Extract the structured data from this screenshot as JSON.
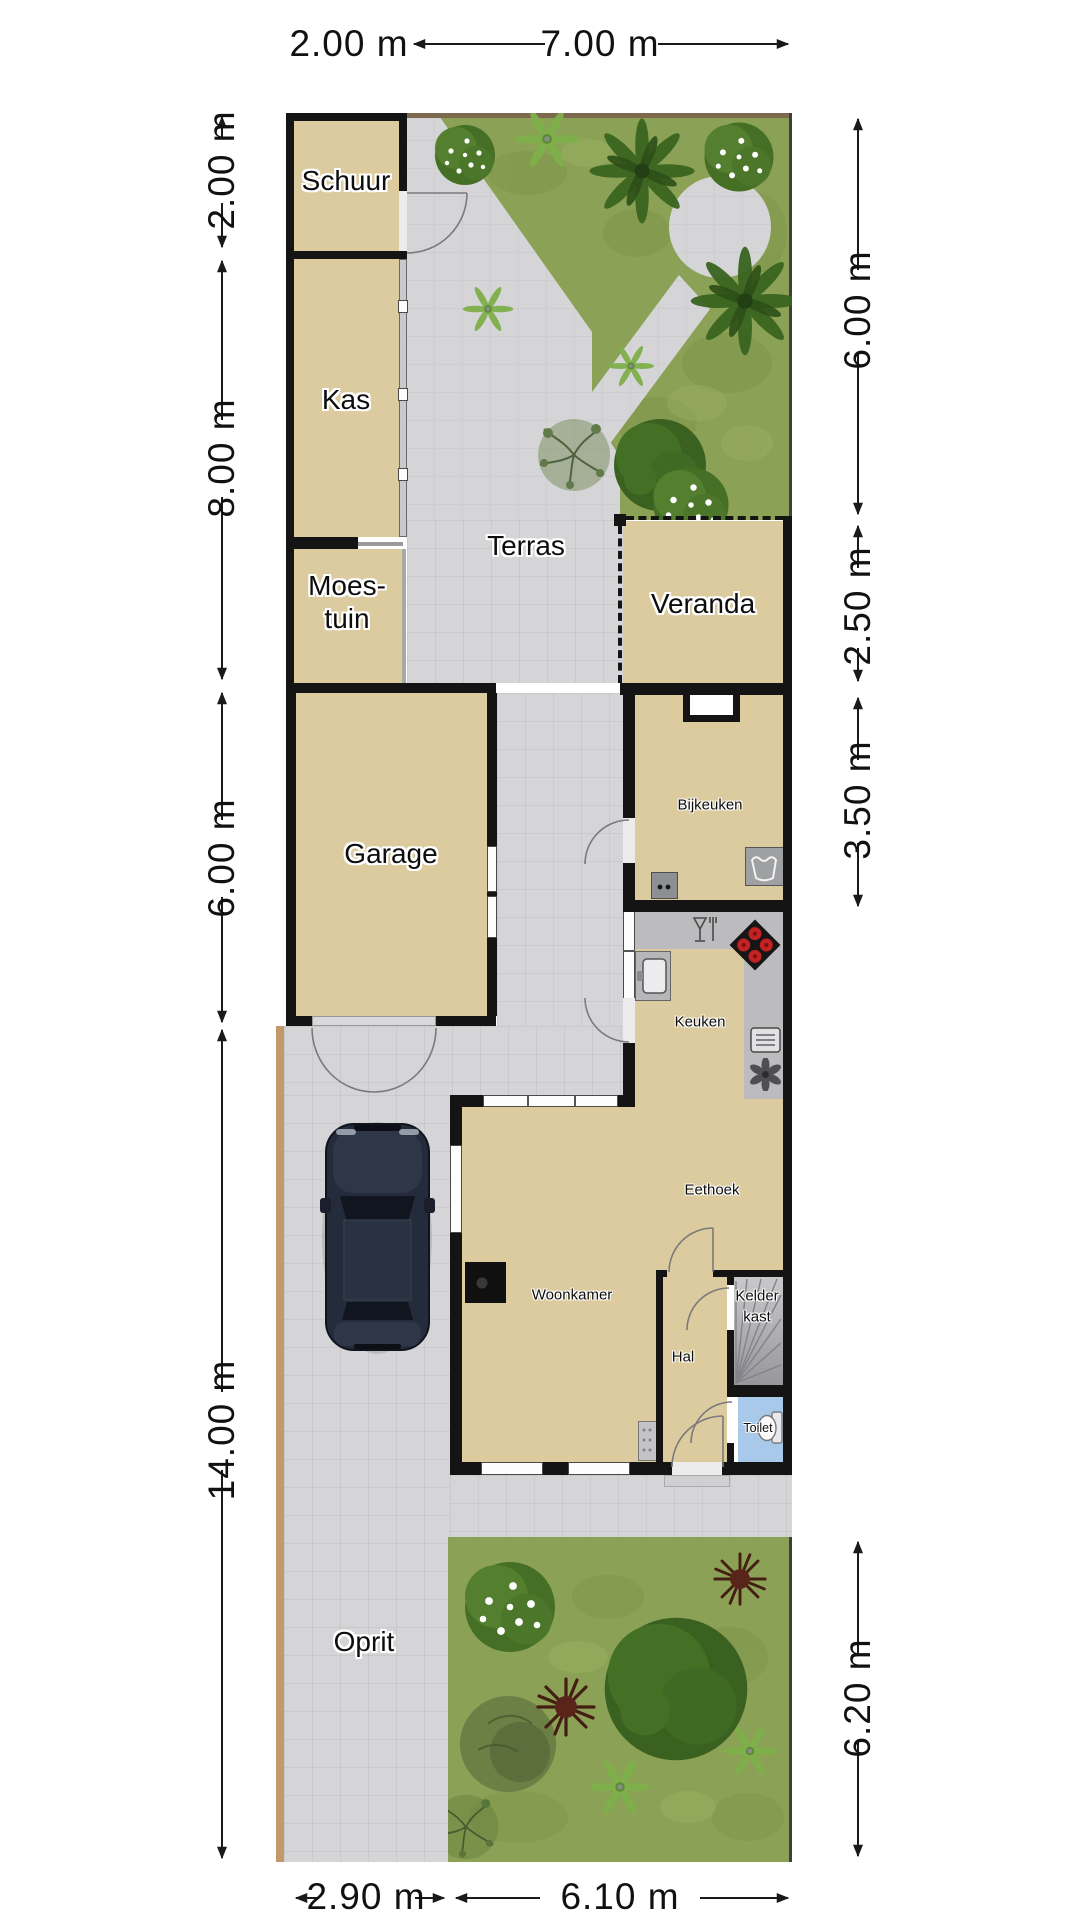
{
  "plan": {
    "type": "floorplan-with-garden",
    "rooms": {
      "schuur": "Schuur",
      "kas": "Kas",
      "moestuin_line1": "Moes-",
      "moestuin_line2": "tuin",
      "terras": "Terras",
      "veranda": "Veranda",
      "garage": "Garage",
      "oprit": "Oprit",
      "bijkeuken": "Bijkeuken",
      "keuken": "Keuken",
      "eethoek": "Eethoek",
      "woonkamer": "Woonkamer",
      "hal": "Hal",
      "kelderkast_line1": "Kelder",
      "kelderkast_line2": "kast",
      "toilet": "Toilet"
    },
    "dimensions": {
      "top": [
        "2.00 m",
        "7.00 m"
      ],
      "left": [
        "2.00 m",
        "8.00 m",
        "6.00 m",
        "14.00 m"
      ],
      "right": [
        "6.00 m",
        "2.50 m",
        "3.50 m",
        "6.20 m"
      ],
      "bottom": [
        "2.90 m",
        "6.10 m"
      ]
    },
    "icons": [
      "washing-machine-icon",
      "boiler-icon",
      "kitchen-sink-icon",
      "stove-icon",
      "dishes-icon",
      "microwave-icon",
      "extractor-fan-icon",
      "toilet-icon",
      "cellar-stairs-icon",
      "fireplace-icon",
      "radiator-cabinet-icon",
      "car",
      "door-arc",
      "window",
      "palm-tree",
      "flower-bush",
      "fern",
      "red-spiky-plant"
    ],
    "colors": {
      "floor_tan": "#dbcb9e",
      "wall_black": "#141414",
      "paving_gray": "#d5d5d7",
      "grass_green": "#8ba155",
      "toilet_blue": "#a9c9ea",
      "counter_gray": "#bcbcbe",
      "stove_burner_red": "#c22222",
      "fence_brown": "#7d6a4e",
      "driveway_edge_tan": "#c2996b"
    }
  }
}
